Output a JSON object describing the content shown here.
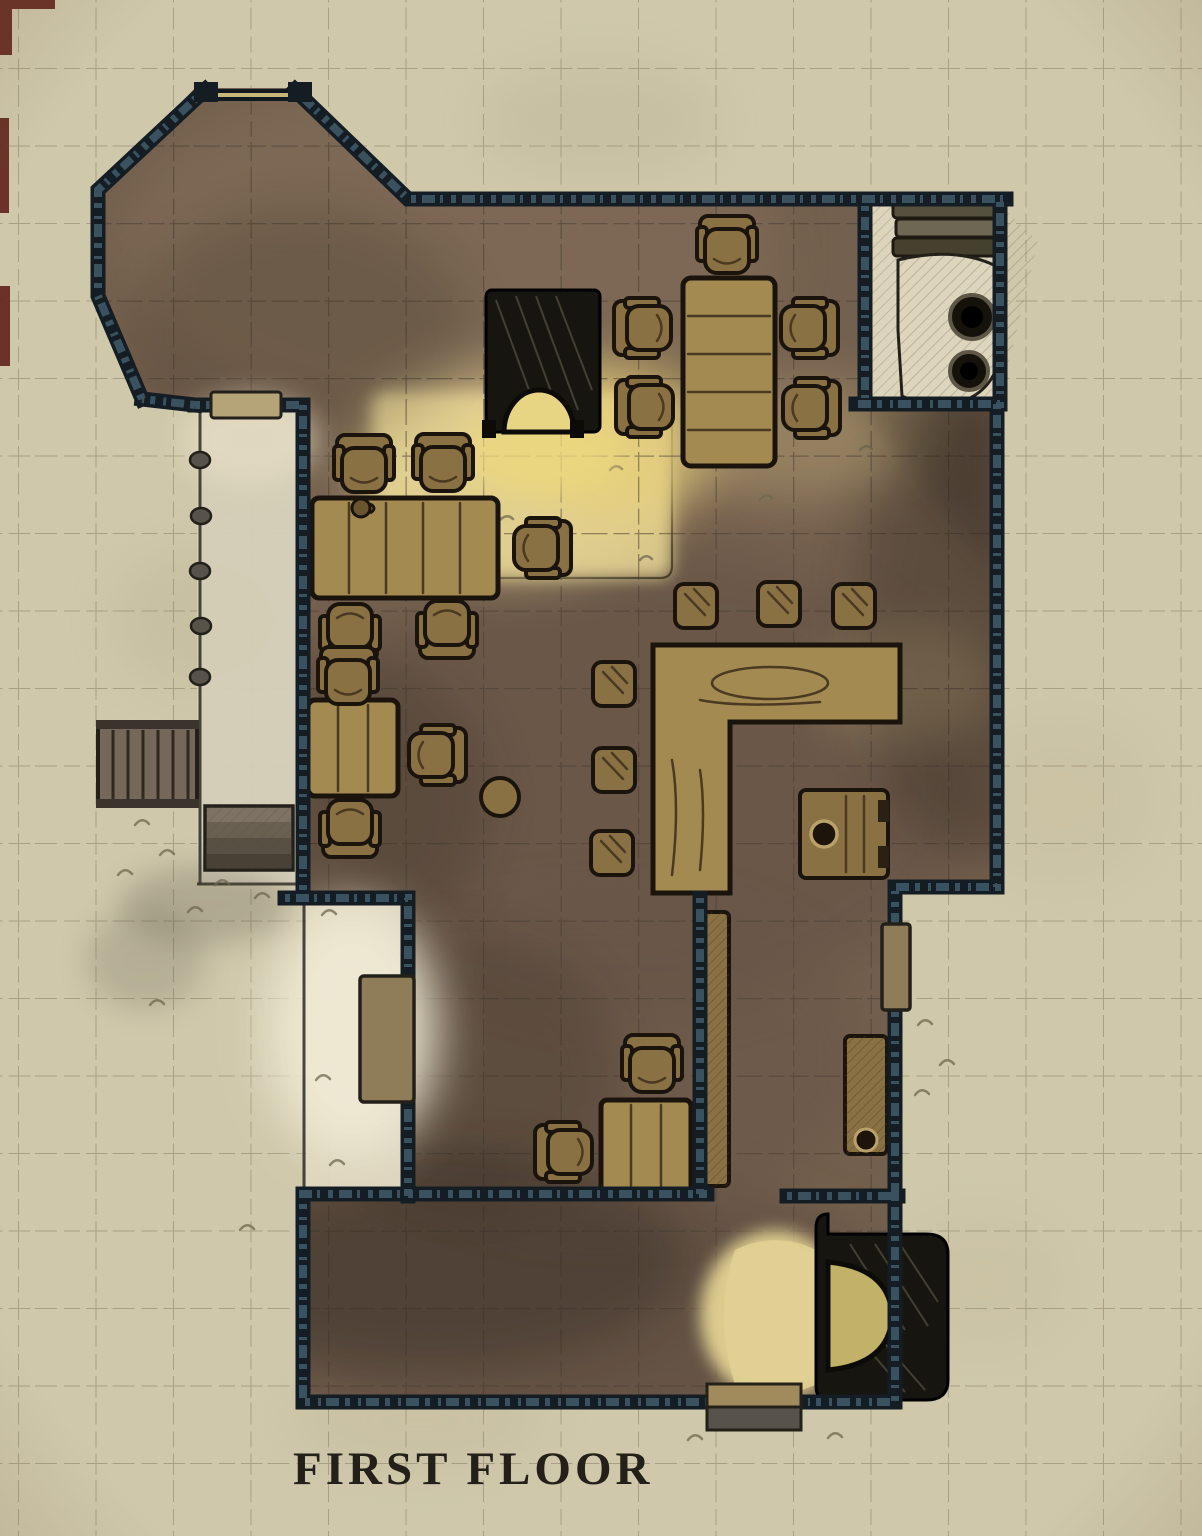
{
  "title": "FIRST FLOOR",
  "palette": {
    "parchment": "#cfc8ab",
    "grid_out": "#8f8669",
    "grid_in": "#4a3e33",
    "floor": "#74604e",
    "floor_light": "#84705a",
    "floor_dark": "#5f4e42",
    "porch": "#d4cdb7",
    "exterior": "#ddd6bf",
    "wall": "#151d24",
    "wall_hatch": "#44606e",
    "wood": "#8a7144",
    "wood_dark": "#1b140d",
    "wood_light": "#a38a51",
    "plank": "#4a3a22",
    "glow": "#e8d584",
    "glow_strong": "#e3cf6f",
    "fire_dark": "#17150f",
    "stone": "#ddd6bd",
    "ink": "#23201a",
    "title": "#232019",
    "shadow": "#241d18",
    "grass": "#6f684f",
    "door": "#b5a478",
    "door_dark": "#8f7c58"
  },
  "map": {
    "rooms": [
      "octagon-room",
      "main-hall",
      "porch",
      "kitchen-nook",
      "lower-west-room",
      "lower-east-room",
      "bottom-room",
      "exterior-yard"
    ],
    "furniture": [
      "north-fireplace",
      "south-fireplace",
      "long-dining-table",
      "large-table",
      "small-table",
      "desk",
      "bar-counter",
      "strongbox-chest",
      "storage-cabinet",
      "wall-bench",
      "wood-pile",
      "stone-hearth-with-pots",
      "chairs",
      "bar-stools",
      "floor-stools",
      "round-stool",
      "tankard"
    ],
    "doors": [
      "porch-door",
      "window-north",
      "west-yard-door",
      "east-exterior-door",
      "south-entrance-step",
      "bottom-doorway"
    ],
    "stairs": [
      "west-stairs",
      "south-stairs"
    ]
  }
}
